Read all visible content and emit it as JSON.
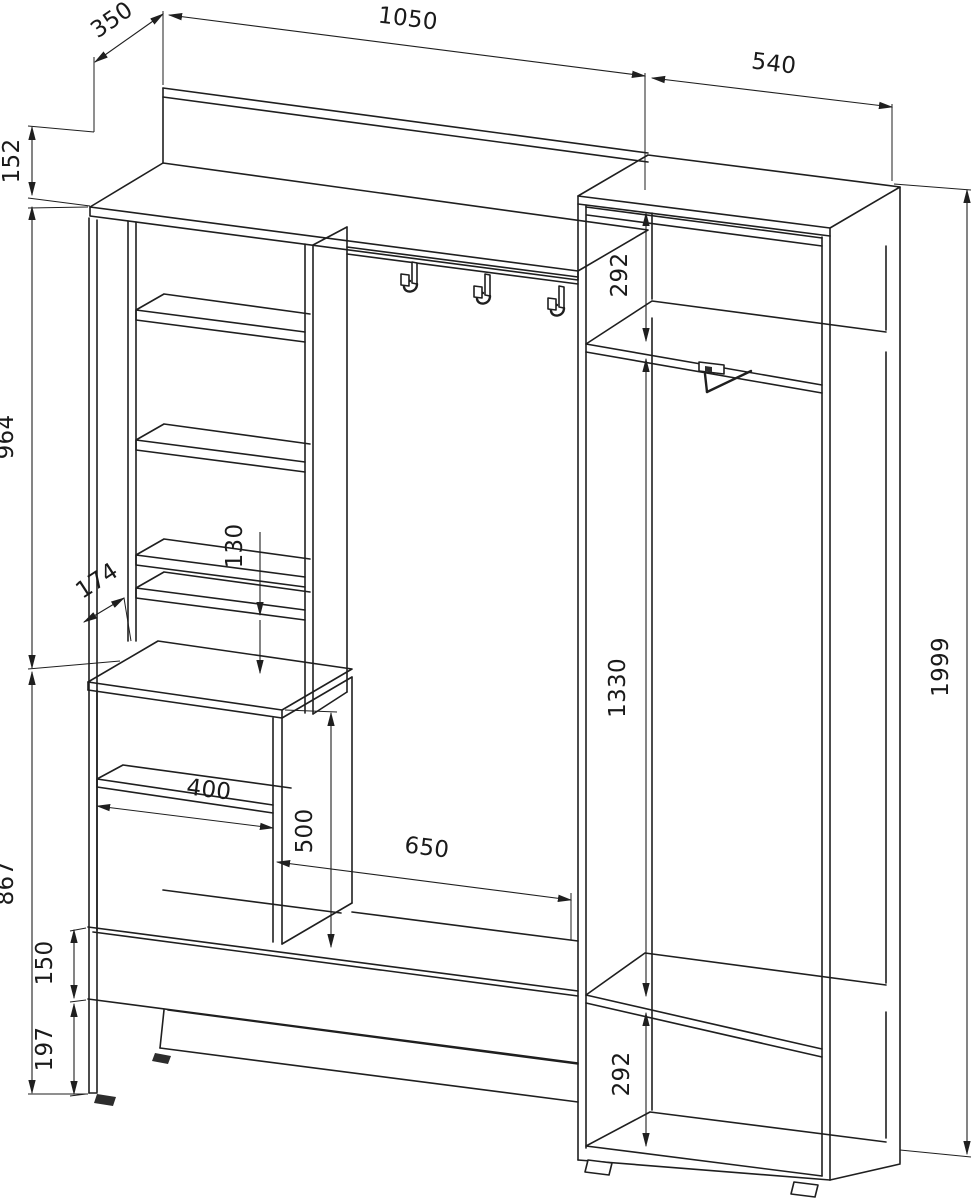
{
  "drawing": {
    "title": "Hallway wardrobe unit technical drawing",
    "units": "mm",
    "line_color": "#1f1f1f",
    "background": "#ffffff"
  },
  "dimensions": {
    "top_shelf_depth": "350",
    "left_section_width": "1050",
    "wardrobe_width": "540",
    "back_rail_height": "152",
    "shelf_column_height": "964",
    "shelf_column_depth": "174",
    "slot_gap_height": "130",
    "lower_section_height": "867",
    "lower_cabinet_inner_width": "400",
    "lower_cabinet_height": "500",
    "bench_opening_width": "650",
    "bench_apron_height": "150",
    "bench_floor_clearance": "197",
    "wardrobe_top_shelf_space": "292",
    "wardrobe_hanging_space": "1330",
    "wardrobe_bottom_shelf_space": "292",
    "wardrobe_total_height": "1999"
  }
}
